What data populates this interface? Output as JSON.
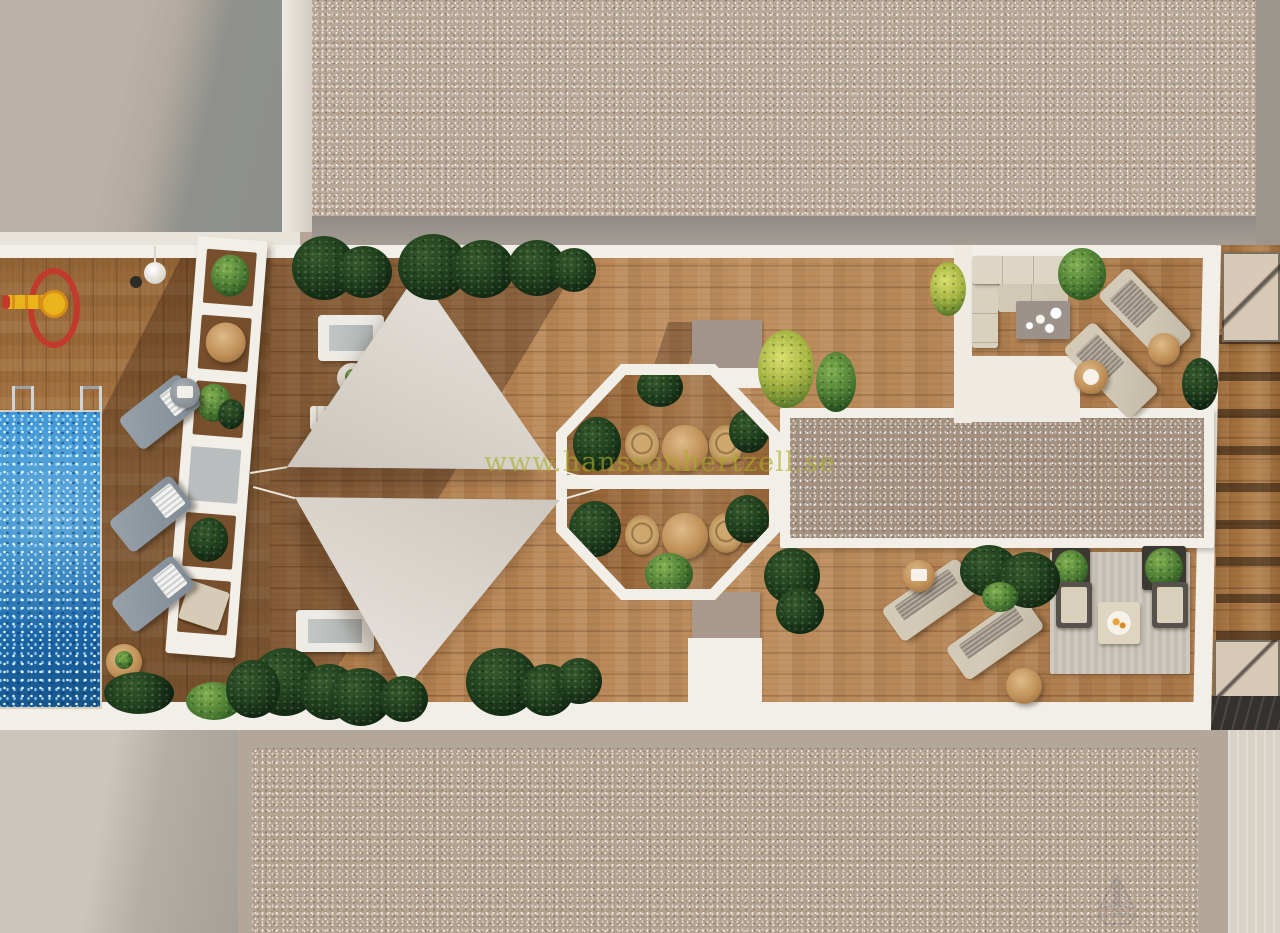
{
  "meta": {
    "title": "Aerial 3D rendering of a rooftop sun terrace"
  },
  "watermark": {
    "site_text": "www.hanssonhertzell.se",
    "logo": "sailboat-sketch"
  },
  "scene": {
    "setting": "top-down aerial view, photorealistic architectural render of a residential rooftop solarium terrace between gravel roofs",
    "elements": [
      "swimming-pool",
      "pool-ladders",
      "kids-spring-toy",
      "pool-deck",
      "slatted-pergola",
      "grey-sun-loungers",
      "white-sun-loungers",
      "shade-sail-upper",
      "shade-sail-lower",
      "octagonal-dining-pergola",
      "bistro-tables",
      "rattan-chairs",
      "roof-skylight-strip",
      "corner-sofa",
      "coffee-table",
      "beige-sun-loungers",
      "side-tables",
      "outdoor-rug",
      "armchairs",
      "planter-boxes",
      "tropical-planting",
      "stair-bulkhead",
      "neighbor-terrace",
      "stair-landings",
      "gravel-roof",
      "concrete-roof"
    ]
  },
  "colors": {
    "wood": "#b5814f",
    "roof": "#b9a897",
    "white": "#f2efe8",
    "pool": "#2d86c7",
    "sail": "#d9d4cc",
    "taupe": "#b3a79a",
    "toyred": "#c23a2c",
    "toyyellow": "#e9b31c",
    "wm": "#a9ad28"
  }
}
